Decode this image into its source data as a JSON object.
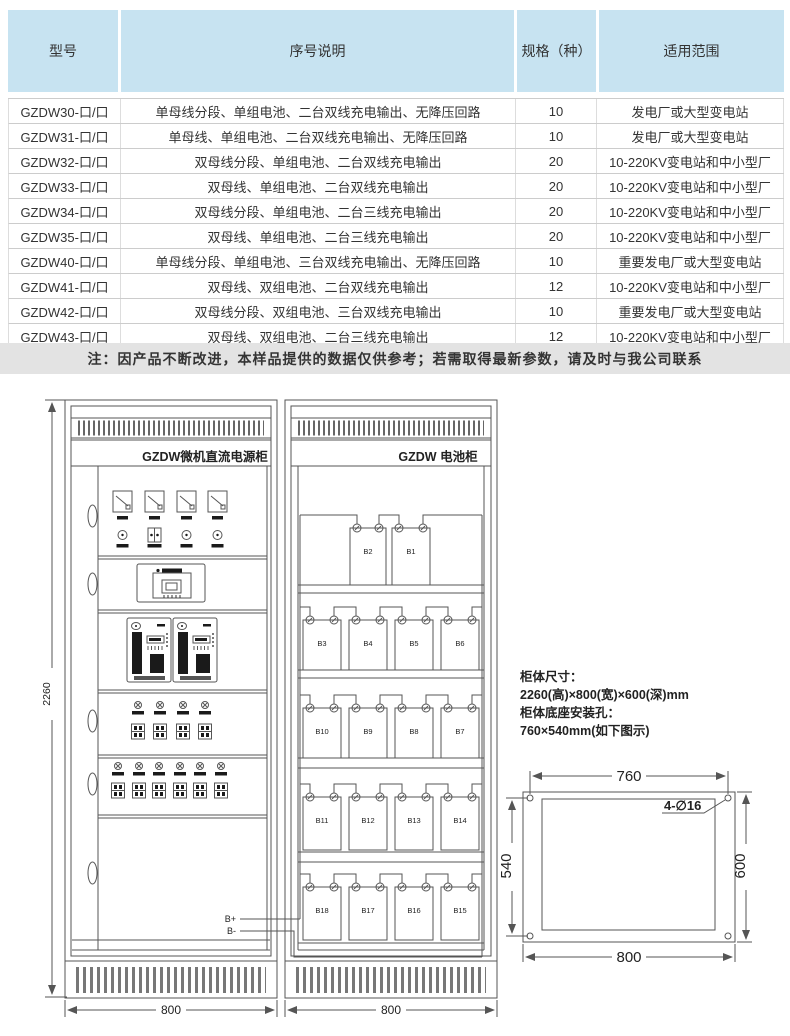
{
  "table": {
    "headers": [
      "型号",
      "序号说明",
      "规格（种）",
      "适用范围"
    ],
    "rows": [
      [
        "GZDW30-口/口",
        "单母线分段、单组电池、二台双线充电输出、无降压回路",
        "10",
        "发电厂或大型变电站"
      ],
      [
        "GZDW31-口/口",
        "单母线、单组电池、二台双线充电输出、无降压回路",
        "10",
        "发电厂或大型变电站"
      ],
      [
        "GZDW32-口/口",
        "双母线分段、单组电池、二台双线充电输出",
        "20",
        "10-220KV变电站和中小型厂"
      ],
      [
        "GZDW33-口/口",
        "双母线、单组电池、二台双线充电输出",
        "20",
        "10-220KV变电站和中小型厂"
      ],
      [
        "GZDW34-口/口",
        "双母线分段、单组电池、二台三线充电输出",
        "20",
        "10-220KV变电站和中小型厂"
      ],
      [
        "GZDW35-口/口",
        "双母线、单组电池、二台三线充电输出",
        "20",
        "10-220KV变电站和中小型厂"
      ],
      [
        "GZDW40-口/口",
        "单母线分段、单组电池、三台双线充电输出、无降压回路",
        "10",
        "重要发电厂或大型变电站"
      ],
      [
        "GZDW41-口/口",
        "双母线、双组电池、二台双线充电输出",
        "12",
        "10-220KV变电站和中小型厂"
      ],
      [
        "GZDW42-口/口",
        "双母线分段、双组电池、三台双线充电输出",
        "10",
        "重要发电厂或大型变电站"
      ],
      [
        "GZDW43-口/口",
        "双母线、双组电池、二台三线充电输出",
        "12",
        "10-220KV变电站和中小型厂"
      ]
    ]
  },
  "note": "注：因产品不断改进，本样品提供的数据仅供参考；若需取得最新参数，请及时与我公司联系",
  "diagram": {
    "left_cabinet_title": "GZDW微机直流电源柜",
    "right_cabinet_title": "GZDW 电池柜",
    "height_dim": "2260",
    "left_width_dim": "800",
    "right_width_dim": "800",
    "bus_positive": "B+",
    "bus_negative": "B-",
    "battery_shelves": [
      [
        "B2",
        "B1"
      ],
      [
        "B3",
        "B4",
        "B5",
        "B6"
      ],
      [
        "B10",
        "B9",
        "B8",
        "B7"
      ],
      [
        "B11",
        "B12",
        "B13",
        "B14"
      ],
      [
        "B18",
        "B17",
        "B16",
        "B15"
      ]
    ],
    "specs": {
      "size_title": "柜体尺寸：",
      "size_value": "2260(高)×800(宽)×600(深)mm",
      "holes_title": "柜体底座安装孔：",
      "holes_value": "760×540mm(如下图示)"
    },
    "base_plan": {
      "top_dim": "760",
      "left_dim": "540",
      "right_dim": "600",
      "bottom_dim": "800",
      "holes_label": "4-∅16"
    }
  },
  "colors": {
    "header_bg": "#c7e3f1",
    "note_bg": "#e3e3e3",
    "line": "#555555"
  }
}
